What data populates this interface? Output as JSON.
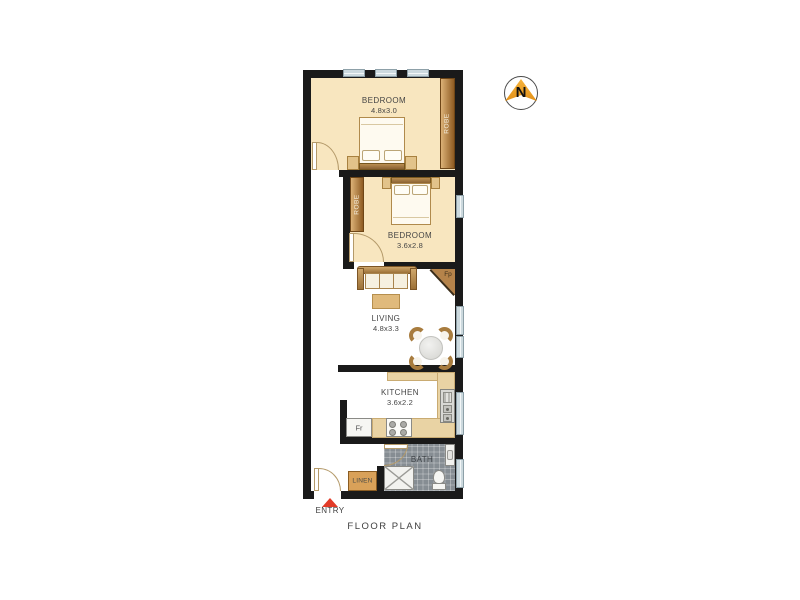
{
  "title": "FLOOR PLAN",
  "compass": {
    "north_label": "N"
  },
  "entry": {
    "label": "ENTRY"
  },
  "rooms": {
    "bedroom1": {
      "name": "BEDROOM",
      "dims": "4.8x3.0",
      "robe_label": "ROBE"
    },
    "bedroom2": {
      "name": "BEDROOM",
      "dims": "3.6x2.8",
      "robe_label": "ROBE"
    },
    "living": {
      "name": "LIVING",
      "dims": "4.8x3.3",
      "fireplace_label": "Fp"
    },
    "kitchen": {
      "name": "KITCHEN",
      "dims": "3.6x2.2",
      "fridge_label": "Fr"
    },
    "bath": {
      "name": "BATH"
    },
    "linen": {
      "label": "LINEN"
    }
  },
  "colors": {
    "wall": "#1a1a1a",
    "room_fill": "#f8e6bf",
    "counter": "#e9d3a4",
    "robe_dark": "#8e5b22",
    "robe_light": "#dcb277",
    "tile": "#868d93",
    "linen_fill": "#d9a159",
    "window": "#ccd9de",
    "entry_arrow": "#e23b28",
    "compass_gold": "#f0a028",
    "text": "#454545"
  }
}
